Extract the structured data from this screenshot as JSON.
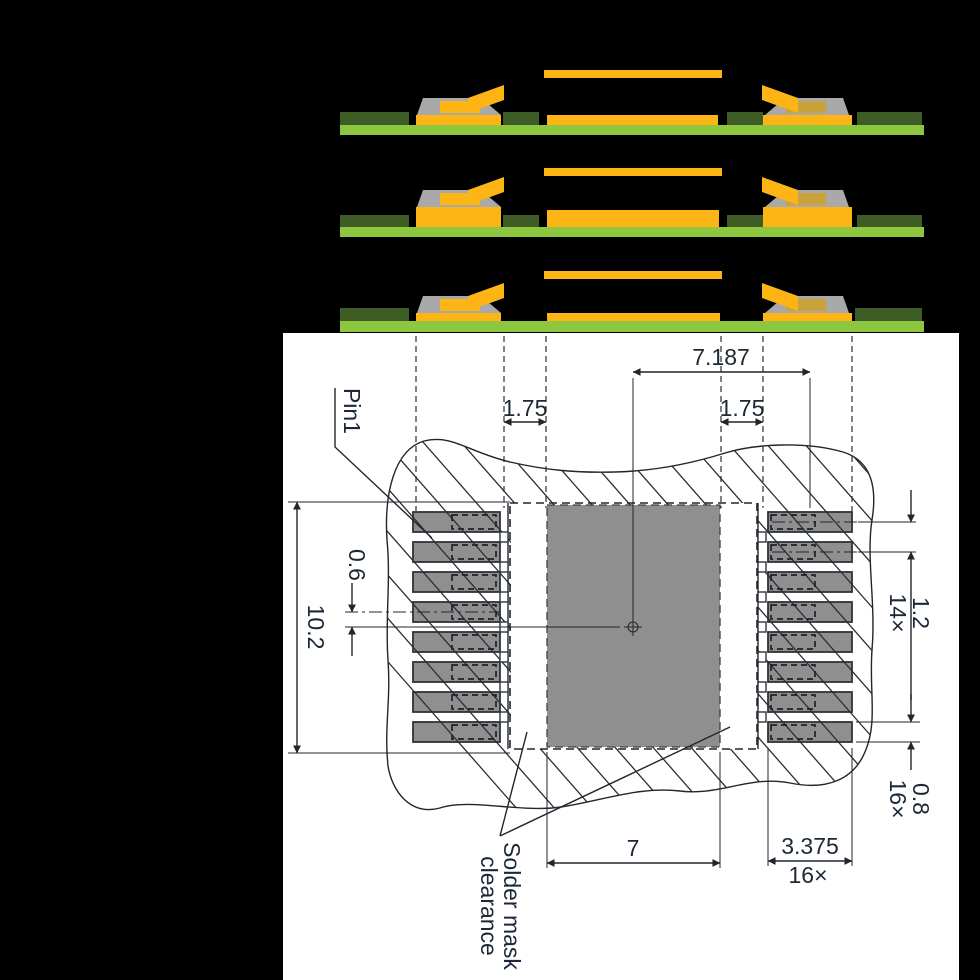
{
  "figure": {
    "type": "PCB land pattern example with solder mask cross-sections",
    "background": "#000000",
    "canvas": "#ffffff",
    "colors": {
      "board_green": "#8dc63f",
      "solder_mask_dark_green": "#3e5c25",
      "copper_yellow": "#fdb515",
      "lead_inner_yellow": "#c9a23c",
      "lead_gray": "#a9a9a9",
      "pad_gray": "#8f8f8f",
      "line_dark": "#20262c"
    },
    "cross_sections": {
      "count": 3
    },
    "annotations": {
      "pin1": "Pin1",
      "solder_mask_clearance_line1": "Solder mask",
      "solder_mask_clearance_line2": "clearance"
    },
    "dimensions": {
      "center_to_pad_center": "7.187",
      "left_mask_clearance": "1.75",
      "right_mask_clearance": "1.75",
      "pad_row_offset": "0.6",
      "pattern_height": "10.2",
      "pad_pitch": "1.2",
      "pad_pitch_count": "14×",
      "pad_width": "0.8",
      "pad_width_count": "16×",
      "thermal_pad_width": "7",
      "pad_length": "3.375",
      "pad_length_count": "16×"
    }
  }
}
